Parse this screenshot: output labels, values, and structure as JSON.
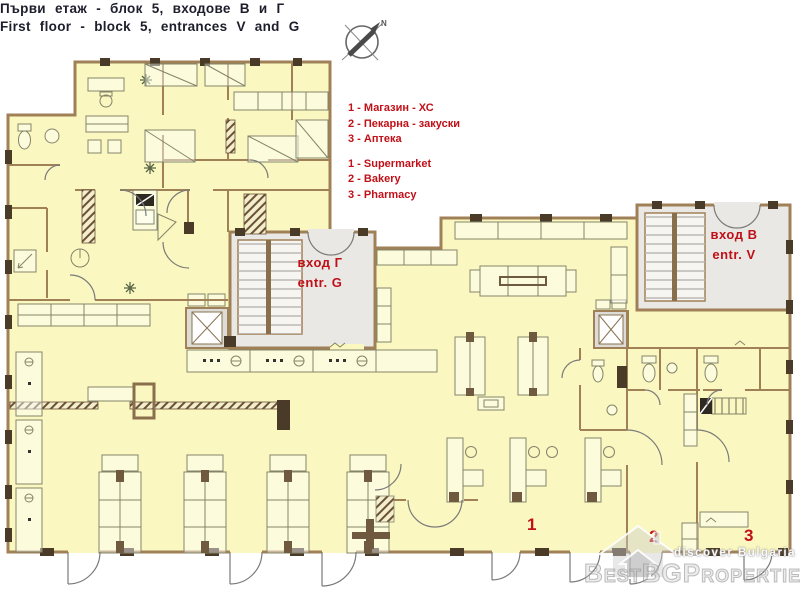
{
  "title": {
    "bg": "Първи етаж - блок 5, входове В и Г",
    "en": "First floor - block 5, entrances V and G"
  },
  "compass": {
    "north": "N"
  },
  "legend": {
    "bg": [
      "1 - Магазин - ХС",
      "2 - Пекарна - закуски",
      "3 - Аптека"
    ],
    "en": [
      "1 - Supermarket",
      "2 - Bakery",
      "3 - Pharmacy"
    ]
  },
  "entrances": {
    "g": {
      "bg": "вход Г",
      "en": "entr. G"
    },
    "v": {
      "bg": "вход В",
      "en": "entr. V"
    }
  },
  "units": {
    "supermarket": "1",
    "bakery": "2",
    "pharmacy": "3"
  },
  "watermark": {
    "brand": "BestBGProperties",
    "tagline": "discover Bulgaria"
  },
  "colors": {
    "accent-red": "#c01018",
    "title-ink": "#1d1d2b",
    "room-yellow": "#faf7c0",
    "wall-brown": "#a08057",
    "wall-dark": "#4a3a28",
    "lobby-gray": "#e9e8e5"
  }
}
